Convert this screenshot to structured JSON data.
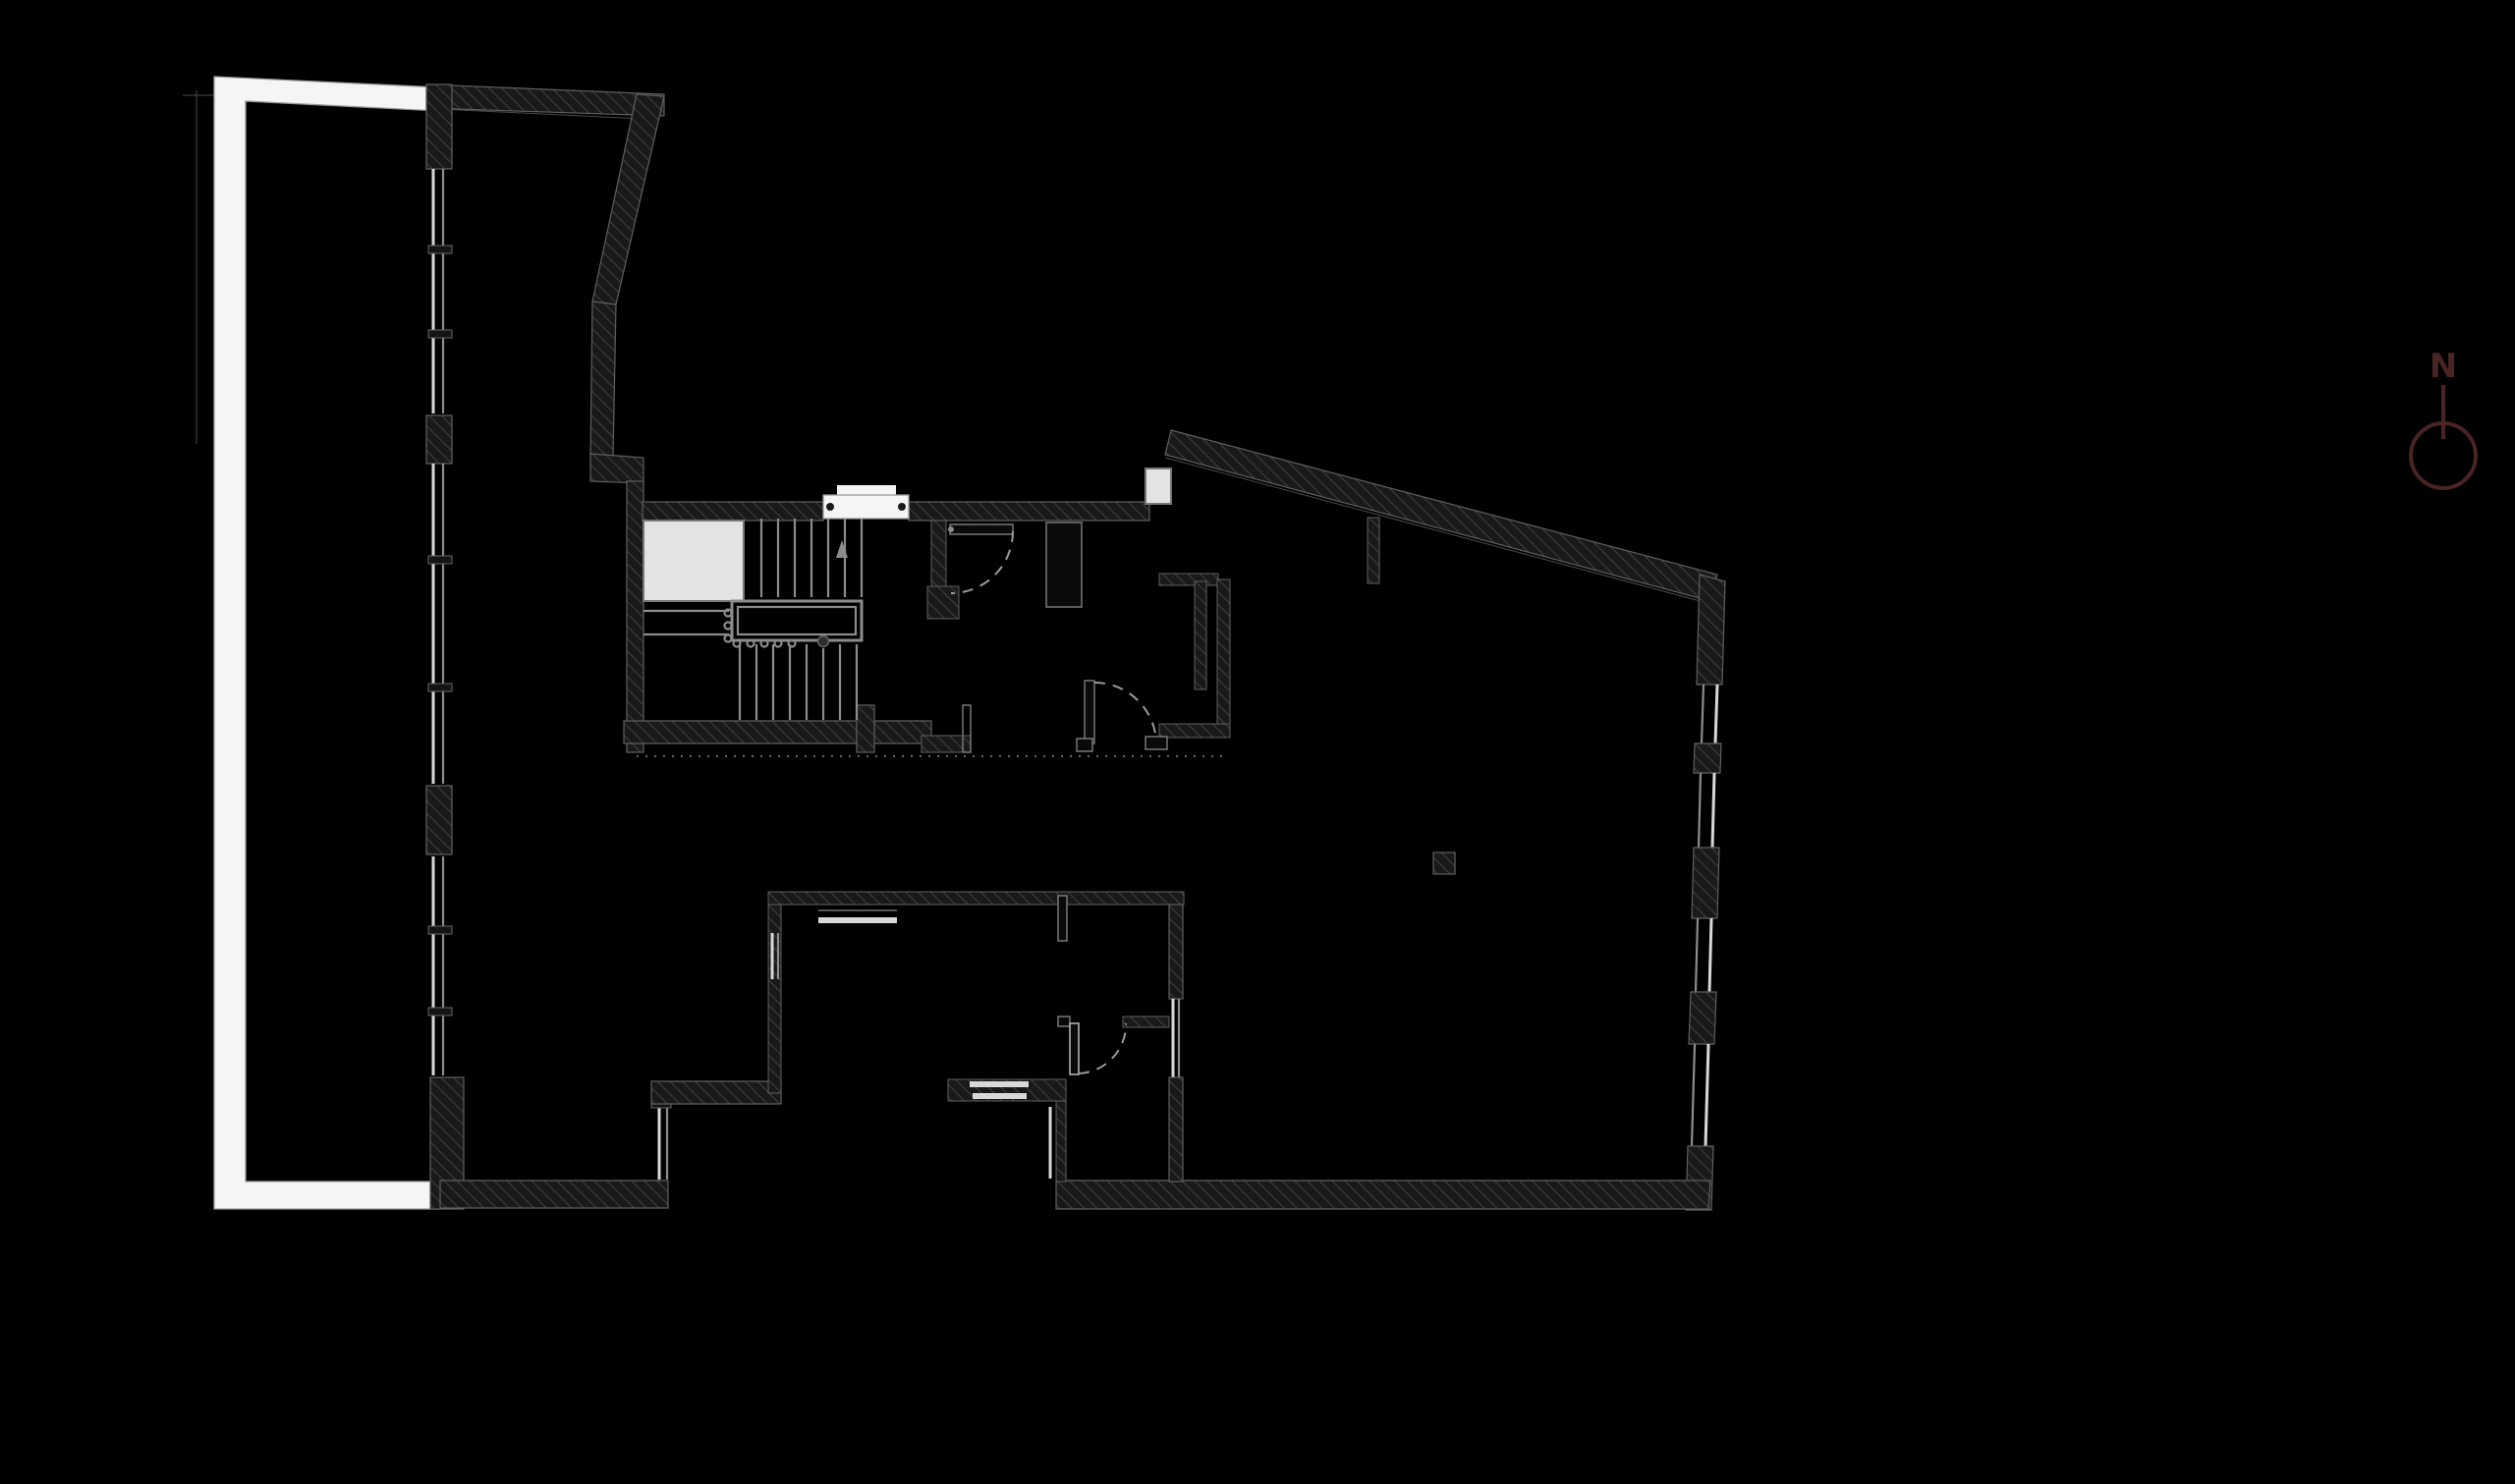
{
  "page": {
    "background_color": "#000000",
    "drawing_type": "architectural-floor-plan"
  },
  "north_arrow": {
    "label": "N",
    "color": "#4a2323"
  },
  "colors": {
    "background": "#000000",
    "wall_fill": "#191919",
    "wall_hatch_line": "#3d3d3d",
    "wall_edge": "#5f5f5f",
    "line_mid_gray": "#8c8c8c",
    "line_light": "#d8d8d8",
    "white_fill": "#f5f5f5",
    "elevator_fill": "#e3e3e3",
    "dashed_arc": "#9a9a9a",
    "north_color": "#4a2323"
  }
}
